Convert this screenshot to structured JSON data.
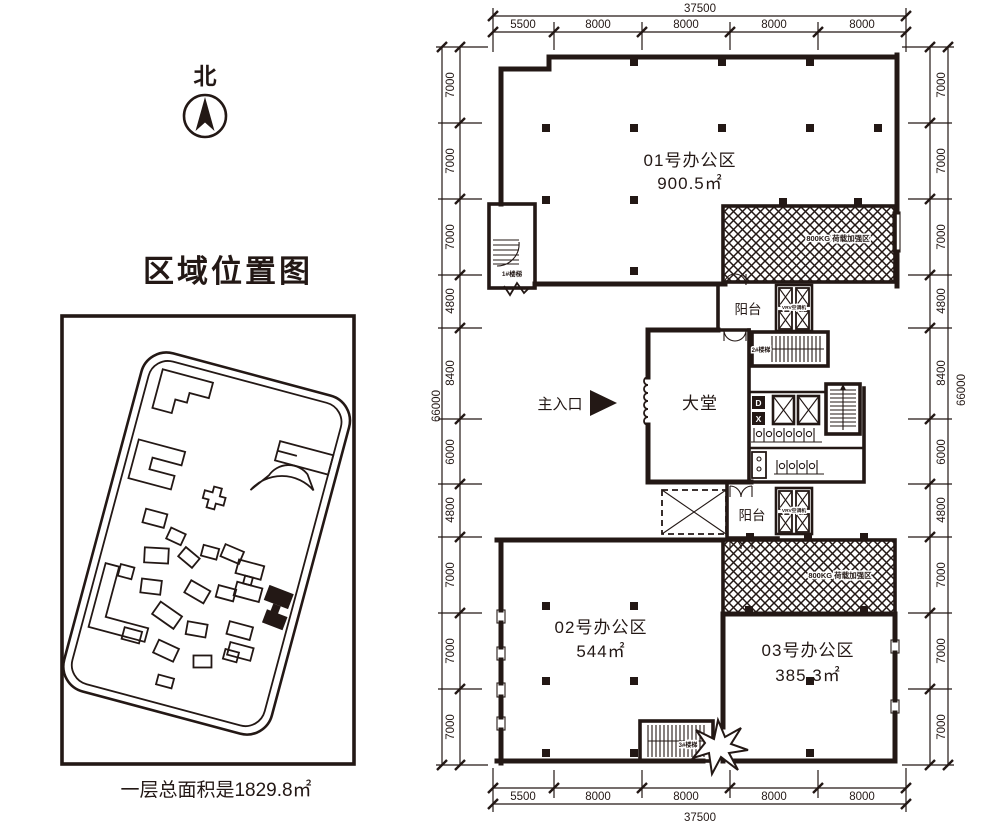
{
  "colors": {
    "ink": "#231815",
    "paper": "#ffffff"
  },
  "north": {
    "label": "北"
  },
  "location_map": {
    "title": "区域位置图",
    "footer": "一层总面积是1829.8㎡"
  },
  "plan": {
    "rooms": {
      "office01": {
        "name": "01号办公区",
        "area": "900.5㎡"
      },
      "office02": {
        "name": "02号办公区",
        "area": "544㎡"
      },
      "office03": {
        "name": "03号办公区",
        "area": "385.3㎡"
      },
      "lobby": {
        "name": "大堂"
      }
    },
    "balcony_top": "阳台",
    "balcony_bottom": "阳台",
    "entrance": "主入口",
    "stairs": {
      "s1": "1#楼梯",
      "s2": "2#楼梯",
      "s3": "3#楼梯"
    },
    "load_zone_top": "800KG 荷载加强区",
    "load_zone_bottom": "800KG 荷载加强区",
    "vrv_top": "VRV空调机",
    "vrv_bottom": "VRV空调机",
    "core": {
      "mark_d": "D",
      "mark_x": "X"
    }
  },
  "dims": {
    "top": {
      "total": "37500",
      "segments": [
        "5500",
        "8000",
        "8000",
        "8000",
        "8000"
      ]
    },
    "bottom": {
      "total": "37500",
      "segments": [
        "5500",
        "8000",
        "8000",
        "8000",
        "8000"
      ]
    },
    "left": {
      "total": "66000",
      "segments": [
        "7000",
        "7000",
        "7000",
        "4800",
        "8400",
        "6000",
        "4800",
        "7000",
        "7000",
        "7000"
      ]
    },
    "right": {
      "total": "66000",
      "segments": [
        "7000",
        "7000",
        "7000",
        "4800",
        "8400",
        "6000",
        "4800",
        "7000",
        "7000",
        "7000"
      ]
    }
  }
}
